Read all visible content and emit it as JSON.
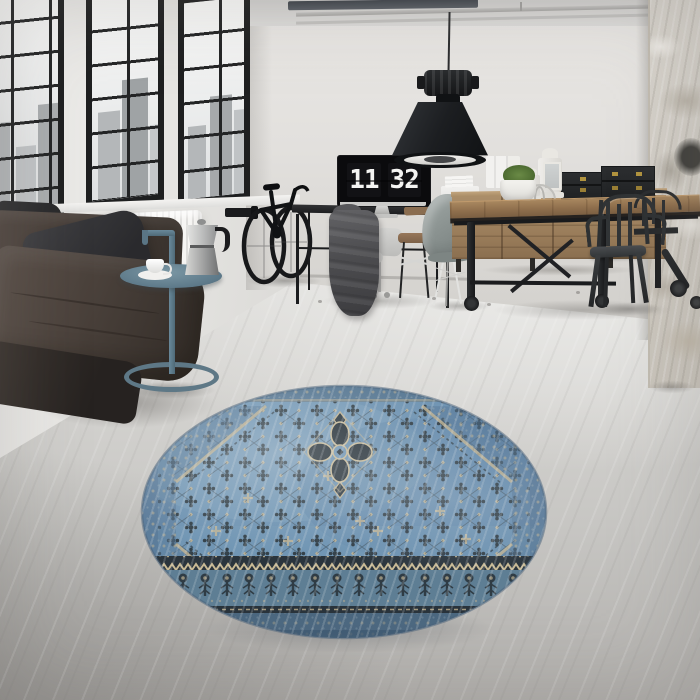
{
  "meta": {
    "type": "interior-photograph",
    "description": "Industrial loft living room: black factory windows with city view, dark leather sofa, blue metal side table with moka pot and coffee cup, wall-mounted bicycle, black pendant lamp, desk with monitor showing a flip clock, grey office and shell chairs, wooden dining table with black metal chairs, wooden sideboard with black trunks, white lanterns and a moss plant, distressed brick column, round distressed blue oriental rug on polished concrete floor"
  },
  "clock": {
    "hours": "11",
    "minutes": "32"
  },
  "objects": [
    "factory-windows",
    "city-skyline",
    "radiator",
    "leather-sofa",
    "black-pillow",
    "blue-side-table",
    "moka-pot",
    "coffee-cup",
    "wall-mounted-bicycle",
    "pendant-lamp",
    "ceiling-pipes",
    "desk",
    "monitor-flip-clock",
    "draped-jacket",
    "office-chairs",
    "wooden-chair",
    "printer-stack",
    "grey-shell-chair",
    "dining-table",
    "sideboard",
    "storage-trunks",
    "lanterns",
    "decor-sphere",
    "potted-plant",
    "metal-tolix-chairs",
    "office-chair-partial",
    "brick-column",
    "round-blue-rug",
    "concrete-floor"
  ],
  "colors": {
    "wall": "#e6e4e1",
    "wall-shade": "#cfcdc9",
    "ceiling": "#d8d7d5",
    "pipe": "#b0afad",
    "floor-light": "#e3e2df",
    "floor-dark": "#a5a3a0",
    "window-frame": "#1e1f20",
    "glass": "#eff0f0",
    "skyline": "#b6b9bb",
    "radiator": "#f2f1ef",
    "sofa-leather": "#453d37",
    "sofa-dark": "#2b2b2d",
    "pillow": "#2c2c2f",
    "side-table-teal": "#5e7886",
    "moka-silver": "#c9c9c9",
    "bike-black": "#131416",
    "desk-metal": "#1f2022",
    "monitor-bezel": "#0b0b0d",
    "clock-digit": "#f4f4f2",
    "jacket-grey": "#4b4b4e",
    "office-chair-grey": "#d0d0ce",
    "shell-chair-grey": "#828a88",
    "chrome": "#d8d8d6",
    "table-wood": "#8a6e50",
    "table-metal": "#212225",
    "sideboard-wood": "#a08565",
    "trunk-black": "#26282a",
    "brass": "#b2943f",
    "lantern-white": "#eceae6",
    "plant-green": "#527034",
    "pot-white": "#f1f0ec",
    "tolix-black": "#2a2c2e",
    "column-plaster": "#d6d2cb",
    "column-shade": "#b3aca0",
    "rug-blue": "#6e93b2",
    "rug-dark": "#2e3940",
    "rug-navy": "#2a343c",
    "rug-beige": "#c3b492",
    "rug-border": "#5e7e94",
    "lamp-black": "#1b1d1f"
  }
}
